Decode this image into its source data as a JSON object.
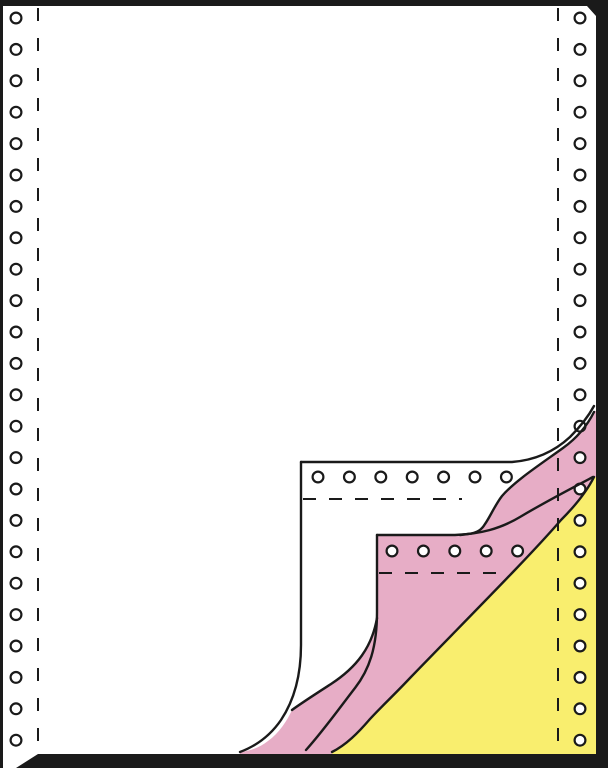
{
  "illustration": {
    "subject": "3-ply continuous fanfold printer paper with curled corner revealing copy sheets",
    "canvas": {
      "width": 608,
      "height": 768
    },
    "colors": {
      "frame": "#1a1a1a",
      "outline": "#1a1a1a",
      "paper_white": "#ffffff",
      "copy_pink": "#e7adc6",
      "copy_yellow": "#f9ee6e",
      "hole_fill": "#ffffff"
    },
    "plies": [
      {
        "name": "top-white-sheet",
        "color": "#ffffff"
      },
      {
        "name": "middle-pink-copy-sheet",
        "color": "#e7adc6"
      },
      {
        "name": "bottom-yellow-copy-sheet",
        "color": "#f9ee6e"
      }
    ],
    "sprocket_holes": {
      "outer_radius": 5.4,
      "ring_width": 2.2,
      "left_column": {
        "x": 16,
        "y_start": 18,
        "y_step": 31.4,
        "count": 24
      },
      "right_column": {
        "x": 580,
        "y_start": 18,
        "y_step": 31.4,
        "count": 24
      },
      "white_flap_row": {
        "y": 477,
        "x_start": 318,
        "x_step": 31.4,
        "count": 7
      },
      "pink_sheet_row": {
        "y": 551,
        "x_start": 392,
        "x_step": 31.4,
        "count": 5
      }
    },
    "perforation_lines": {
      "dash_vertical": "13 17",
      "dash_horizontal": "13 13",
      "left_vertical": {
        "x": 38,
        "y1": 8,
        "y2": 753
      },
      "right_vertical": {
        "x": 558,
        "y1": 8,
        "y2": 753
      },
      "white_flap_horizontal": {
        "y": 499,
        "x1": 303,
        "x2": 462
      },
      "pink_sheet_horizontal": {
        "y": 573,
        "x1": 379,
        "x2": 505
      }
    }
  }
}
